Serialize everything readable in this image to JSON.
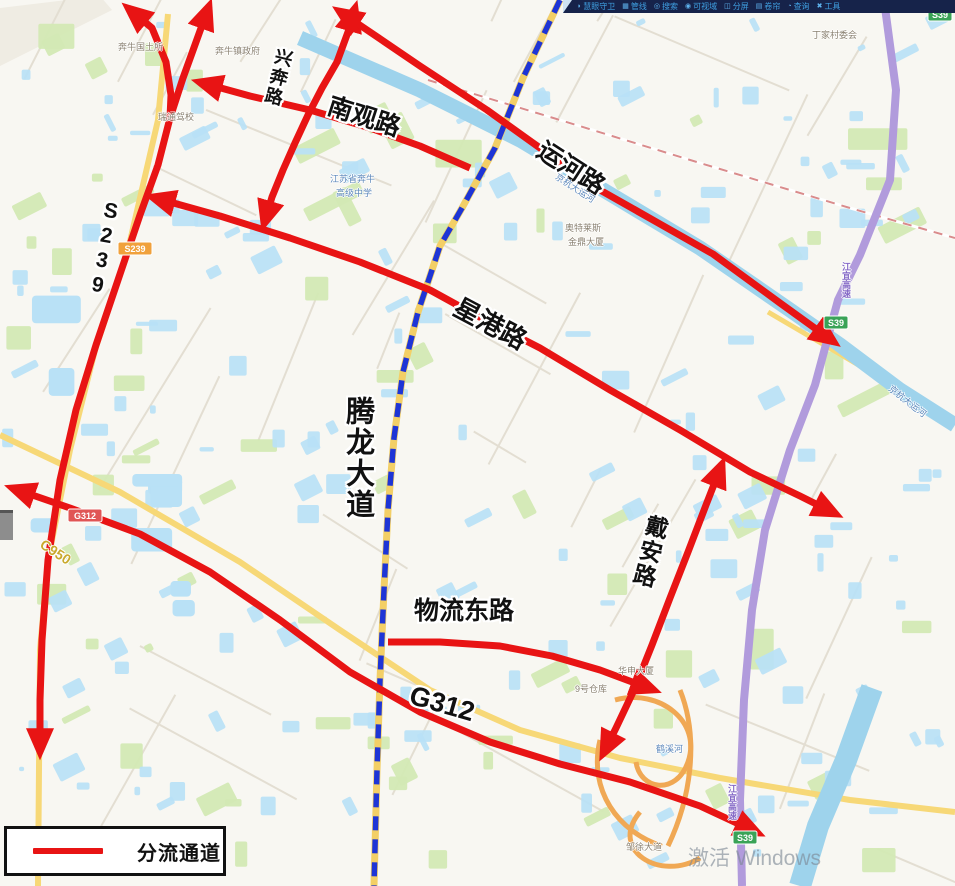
{
  "toolbar": {
    "items": [
      {
        "icon": "◗",
        "label": "慧眼守卫"
      },
      {
        "icon": "▦",
        "label": "管线"
      },
      {
        "icon": "◎",
        "label": "搜索"
      },
      {
        "icon": "◉",
        "label": "可视域"
      },
      {
        "icon": "◫",
        "label": "分屏"
      },
      {
        "icon": "▤",
        "label": "卷帘"
      },
      {
        "icon": "◔",
        "label": "查询"
      },
      {
        "icon": "✖",
        "label": "工具"
      }
    ]
  },
  "legend": {
    "label": "分流通道",
    "line_color": "#e81414"
  },
  "watermark": {
    "text": "激活 Windows"
  },
  "map": {
    "seed": 11,
    "colors": {
      "background": "#f8f7f2",
      "route": "#e81414",
      "dashed_avenue": "#1e35d6",
      "avenue_under": "#f3cf66",
      "water": "#b9e1f6",
      "canal": "#9ed3ec",
      "green": "#d3e9b4",
      "yellow_road": "#f7d877",
      "purple_highway": "#b19bdc",
      "minor_road": "#e3ded2",
      "railway": "#d98c8c",
      "ramp": "#f0a854"
    },
    "road_labels": [
      {
        "text": "兴奔路",
        "x": 276,
        "y": 46,
        "size": 18,
        "rot": 14,
        "vertical": true
      },
      {
        "text": "南观路",
        "x": 332,
        "y": 94,
        "size": 25,
        "rot": 18,
        "vertical": false
      },
      {
        "text": "运河路",
        "x": 546,
        "y": 138,
        "size": 25,
        "rot": 33,
        "vertical": false
      },
      {
        "text": "S239",
        "x": 102,
        "y": 198,
        "size": 21,
        "rot": 10,
        "vertical": true
      },
      {
        "text": "星港路",
        "x": 462,
        "y": 294,
        "size": 26,
        "rot": 28,
        "vertical": false
      },
      {
        "text": "腾龙大道",
        "x": 342,
        "y": 396,
        "size": 29,
        "rot": 0,
        "vertical": true
      },
      {
        "text": "戴安路",
        "x": 646,
        "y": 512,
        "size": 23,
        "rot": 14,
        "vertical": true
      },
      {
        "text": "物流东路",
        "x": 414,
        "y": 599,
        "size": 25,
        "rot": 0,
        "vertical": false
      },
      {
        "text": "G312",
        "x": 414,
        "y": 682,
        "size": 27,
        "rot": 16,
        "vertical": false
      }
    ],
    "poi_labels": [
      {
        "text": "奔牛国土所",
        "x": 118,
        "y": 40,
        "cls": ""
      },
      {
        "text": "奔牛镇政府",
        "x": 215,
        "y": 44,
        "cls": ""
      },
      {
        "text": "瑞通驾校",
        "x": 158,
        "y": 110,
        "cls": ""
      },
      {
        "text": "江苏省奔牛",
        "x": 330,
        "y": 172,
        "cls": "blue"
      },
      {
        "text": "高级中学",
        "x": 336,
        "y": 186,
        "cls": "blue"
      },
      {
        "text": "奥特莱斯",
        "x": 565,
        "y": 221,
        "cls": ""
      },
      {
        "text": "金鼎大厦",
        "x": 568,
        "y": 235,
        "cls": ""
      },
      {
        "text": "丁家村委会",
        "x": 812,
        "y": 28,
        "cls": ""
      },
      {
        "text": "京杭大运河",
        "x": 560,
        "y": 170,
        "cls": "blue",
        "rot": 33
      },
      {
        "text": "华申大厦",
        "x": 618,
        "y": 664,
        "cls": ""
      },
      {
        "text": "9号仓库",
        "x": 575,
        "y": 682,
        "cls": ""
      },
      {
        "text": "鹤溪河",
        "x": 656,
        "y": 742,
        "cls": "blue"
      },
      {
        "text": "邹徐大道",
        "x": 626,
        "y": 840,
        "cls": ""
      },
      {
        "text": "江宜高速",
        "x": 840,
        "y": 262,
        "cls": "purple vert"
      },
      {
        "text": "江宜高速",
        "x": 726,
        "y": 784,
        "cls": "purple vert"
      },
      {
        "text": "京杭大运河",
        "x": 894,
        "y": 382,
        "cls": "blue",
        "rot": 38
      },
      {
        "text": "C950",
        "x": 46,
        "y": 536,
        "cls": "olive",
        "rot": 33,
        "size": 14
      }
    ],
    "shields": [
      {
        "text": "S239",
        "x": 118,
        "y": 242,
        "bg": "#f0a13c"
      },
      {
        "text": "G312",
        "x": 68,
        "y": 509,
        "bg": "#e05555"
      },
      {
        "text": "S39",
        "x": 824,
        "y": 316,
        "bg": "#3aa357"
      },
      {
        "text": "S39",
        "x": 733,
        "y": 831,
        "bg": "#3aa357"
      },
      {
        "text": "S39",
        "x": 928,
        "y": 8,
        "bg": "#3aa357"
      }
    ],
    "routes": [
      {
        "name": "s239-main",
        "arrow_start": true,
        "arrow_end": true,
        "points": [
          [
            128,
            8
          ],
          [
            152,
            28
          ],
          [
            166,
            62
          ],
          [
            171,
            95
          ],
          [
            170,
            118
          ],
          [
            158,
            165
          ],
          [
            140,
            215
          ],
          [
            118,
            280
          ],
          [
            96,
            345
          ],
          [
            76,
            410
          ],
          [
            60,
            480
          ],
          [
            48,
            560
          ],
          [
            42,
            640
          ],
          [
            40,
            700
          ],
          [
            40,
            752
          ]
        ]
      },
      {
        "name": "s239-branch",
        "arrow_start": true,
        "arrow_end": false,
        "points": [
          [
            209,
            6
          ],
          [
            196,
            42
          ],
          [
            183,
            78
          ],
          [
            170,
            118
          ]
        ]
      },
      {
        "name": "xingben-road",
        "arrow_start": true,
        "arrow_end": true,
        "points": [
          [
            355,
            8
          ],
          [
            348,
            32
          ],
          [
            337,
            62
          ],
          [
            322,
            88
          ],
          [
            308,
            115
          ],
          [
            295,
            143
          ],
          [
            283,
            170
          ],
          [
            272,
            197
          ],
          [
            264,
            224
          ]
        ]
      },
      {
        "name": "nanguan-road",
        "arrow_start": true,
        "arrow_end": false,
        "points": [
          [
            199,
            82
          ],
          [
            250,
            96
          ],
          [
            310,
            110
          ],
          [
            370,
            128
          ],
          [
            420,
            146
          ],
          [
            470,
            168
          ]
        ]
      },
      {
        "name": "yunhe-road",
        "arrow_start": true,
        "arrow_end": true,
        "points": [
          [
            339,
            11
          ],
          [
            370,
            32
          ],
          [
            420,
            66
          ],
          [
            487,
            110
          ],
          [
            540,
            148
          ],
          [
            600,
            190
          ],
          [
            660,
            224
          ],
          [
            713,
            254
          ],
          [
            780,
            303
          ],
          [
            834,
            342
          ]
        ]
      },
      {
        "name": "xinggang-road",
        "arrow_start": true,
        "arrow_end": true,
        "points": [
          [
            152,
            197
          ],
          [
            220,
            216
          ],
          [
            290,
            238
          ],
          [
            360,
            262
          ],
          [
            430,
            290
          ],
          [
            470,
            312
          ],
          [
            540,
            348
          ],
          [
            610,
            390
          ],
          [
            680,
            430
          ],
          [
            750,
            472
          ],
          [
            800,
            496
          ],
          [
            836,
            514
          ]
        ]
      },
      {
        "name": "daian-road",
        "arrow_start": true,
        "arrow_end": true,
        "points": [
          [
            722,
            464
          ],
          [
            706,
            505
          ],
          [
            688,
            552
          ],
          [
            670,
            598
          ],
          [
            652,
            645
          ],
          [
            634,
            690
          ],
          [
            616,
            728
          ],
          [
            603,
            754
          ]
        ]
      },
      {
        "name": "wuliu-east-road",
        "arrow_start": false,
        "arrow_end": true,
        "points": [
          [
            388,
            642
          ],
          [
            440,
            642
          ],
          [
            500,
            646
          ],
          [
            552,
            656
          ],
          [
            600,
            670
          ],
          [
            654,
            690
          ]
        ]
      },
      {
        "name": "g312",
        "arrow_start": true,
        "arrow_end": true,
        "points": [
          [
            12,
            488
          ],
          [
            70,
            508
          ],
          [
            140,
            534
          ],
          [
            210,
            572
          ],
          [
            280,
            620
          ],
          [
            350,
            672
          ],
          [
            420,
            712
          ],
          [
            490,
            742
          ],
          [
            560,
            764
          ],
          [
            630,
            782
          ],
          [
            700,
            806
          ],
          [
            758,
            833
          ]
        ]
      }
    ],
    "dashed_avenue": {
      "name": "tenglong-avenue",
      "points": [
        [
          560,
          0
        ],
        [
          523,
          78
        ],
        [
          495,
          148
        ],
        [
          462,
          208
        ],
        [
          440,
          246
        ],
        [
          418,
          312
        ],
        [
          403,
          372
        ],
        [
          394,
          438
        ],
        [
          388,
          510
        ],
        [
          384,
          590
        ],
        [
          380,
          680
        ],
        [
          377,
          770
        ],
        [
          374,
          886
        ]
      ]
    },
    "canal": {
      "points": [
        [
          300,
          38
        ],
        [
          420,
          90
        ],
        [
          520,
          140
        ],
        [
          620,
          200
        ],
        [
          700,
          248
        ],
        [
          790,
          310
        ],
        [
          840,
          345
        ],
        [
          900,
          390
        ],
        [
          955,
          425
        ]
      ],
      "width": 15
    },
    "river_south": {
      "points": [
        [
          872,
          688
        ],
        [
          846,
          760
        ],
        [
          818,
          826
        ],
        [
          800,
          886
        ]
      ],
      "width": 22
    },
    "purple_highway": {
      "points": [
        [
          884,
          0
        ],
        [
          896,
          90
        ],
        [
          890,
          180
        ],
        [
          860,
          255
        ],
        [
          838,
          300
        ],
        [
          815,
          385
        ],
        [
          790,
          450
        ],
        [
          765,
          530
        ],
        [
          752,
          610
        ],
        [
          744,
          700
        ],
        [
          740,
          800
        ],
        [
          742,
          886
        ]
      ],
      "width": 8
    },
    "railway": {
      "points": [
        [
          428,
          80
        ],
        [
          560,
          120
        ],
        [
          700,
          163
        ],
        [
          850,
          208
        ],
        [
          955,
          238
        ]
      ]
    },
    "yellow_roads": [
      {
        "points": [
          [
            168,
            14
          ],
          [
            158,
            120
          ],
          [
            128,
            250
          ],
          [
            95,
            350
          ],
          [
            70,
            450
          ],
          [
            48,
            560
          ],
          [
            40,
            650
          ],
          [
            38,
            886
          ]
        ],
        "width": 6
      },
      {
        "points": [
          [
            0,
            435
          ],
          [
            120,
            492
          ],
          [
            240,
            562
          ],
          [
            340,
            630
          ],
          [
            430,
            690
          ],
          [
            520,
            730
          ],
          [
            620,
            758
          ],
          [
            720,
            778
          ],
          [
            850,
            800
          ],
          [
            955,
            812
          ]
        ],
        "width": 6
      },
      {
        "points": [
          [
            768,
            312
          ],
          [
            850,
            360
          ],
          [
            955,
            422
          ]
        ],
        "width": 5
      }
    ],
    "ramps": [
      "M615,700 C660,688 702,722 688,762 C676,796 640,790 636,762",
      "M640,812 C608,850 660,882 700,858",
      "M600,740 C588,790 618,832 662,846",
      "M680,690 C700,740 690,800 668,846"
    ]
  }
}
